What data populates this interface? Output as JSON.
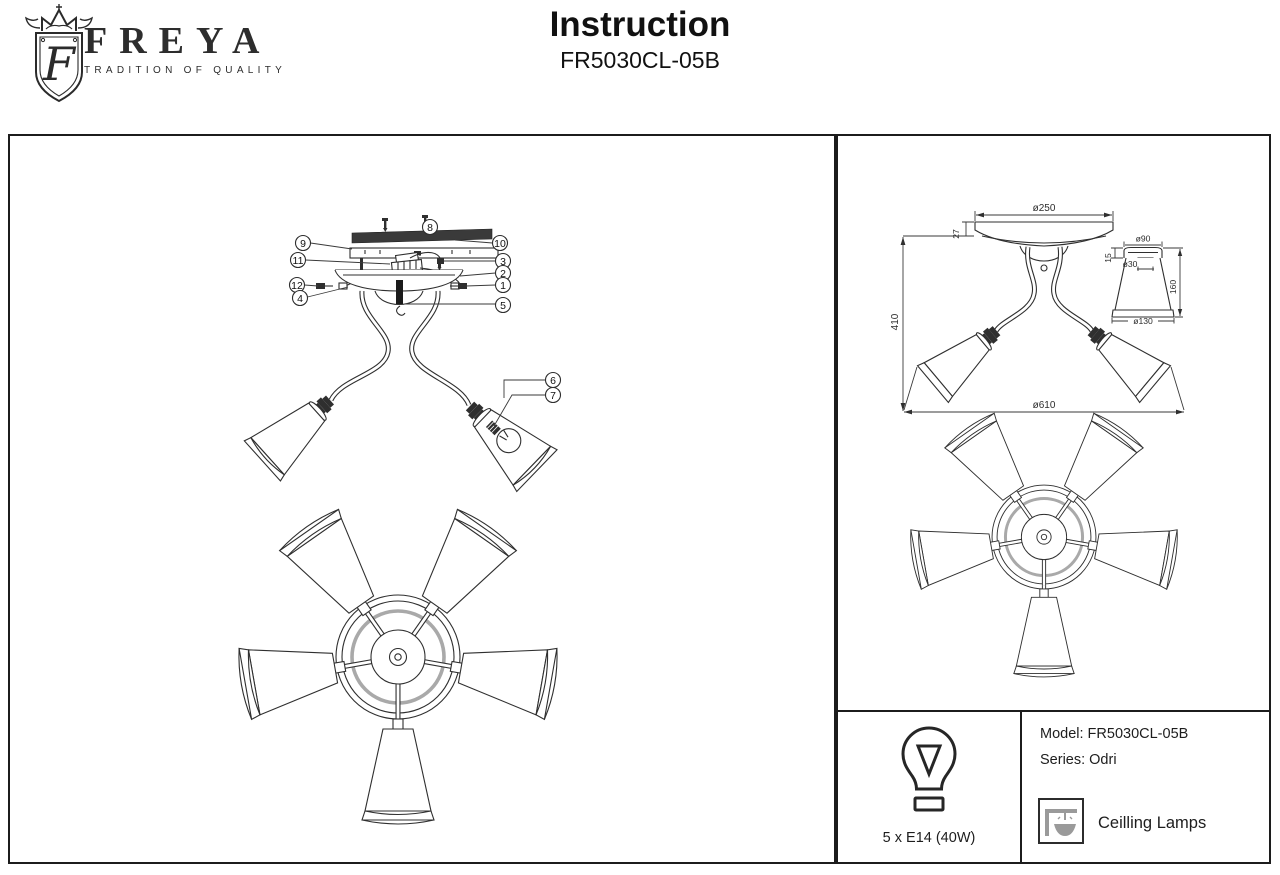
{
  "header": {
    "title": "Instruction",
    "model": "FR5030CL-05B"
  },
  "logo": {
    "brand": "FREYA",
    "tagline": "TRADITION OF QUALITY",
    "monogram": "F"
  },
  "exploded_view": {
    "callouts": [
      {
        "n": "8"
      },
      {
        "n": "9"
      },
      {
        "n": "10"
      },
      {
        "n": "11"
      },
      {
        "n": "3"
      },
      {
        "n": "2"
      },
      {
        "n": "12"
      },
      {
        "n": "1"
      },
      {
        "n": "4"
      },
      {
        "n": "5"
      },
      {
        "n": "6"
      },
      {
        "n": "7"
      }
    ]
  },
  "dimension_view": {
    "canopy_diameter": "ø250",
    "canopy_height": "27",
    "overall_height": "410",
    "overall_diameter": "ø610",
    "shade": {
      "top_diameter": "ø90",
      "neck_height": "15",
      "socket_diameter": "ø30",
      "height": "160",
      "bottom_diameter": "ø130"
    }
  },
  "info": {
    "bulb_spec": "5 x E14 (40W)",
    "model": "Model: FR5030CL-05B",
    "series": "Series: Odri",
    "category": "Ceilling Lamps"
  },
  "colors": {
    "line": "#2f2f2f",
    "panel_border": "#1c1c1c",
    "icon_gray": "#9a9a9a"
  }
}
